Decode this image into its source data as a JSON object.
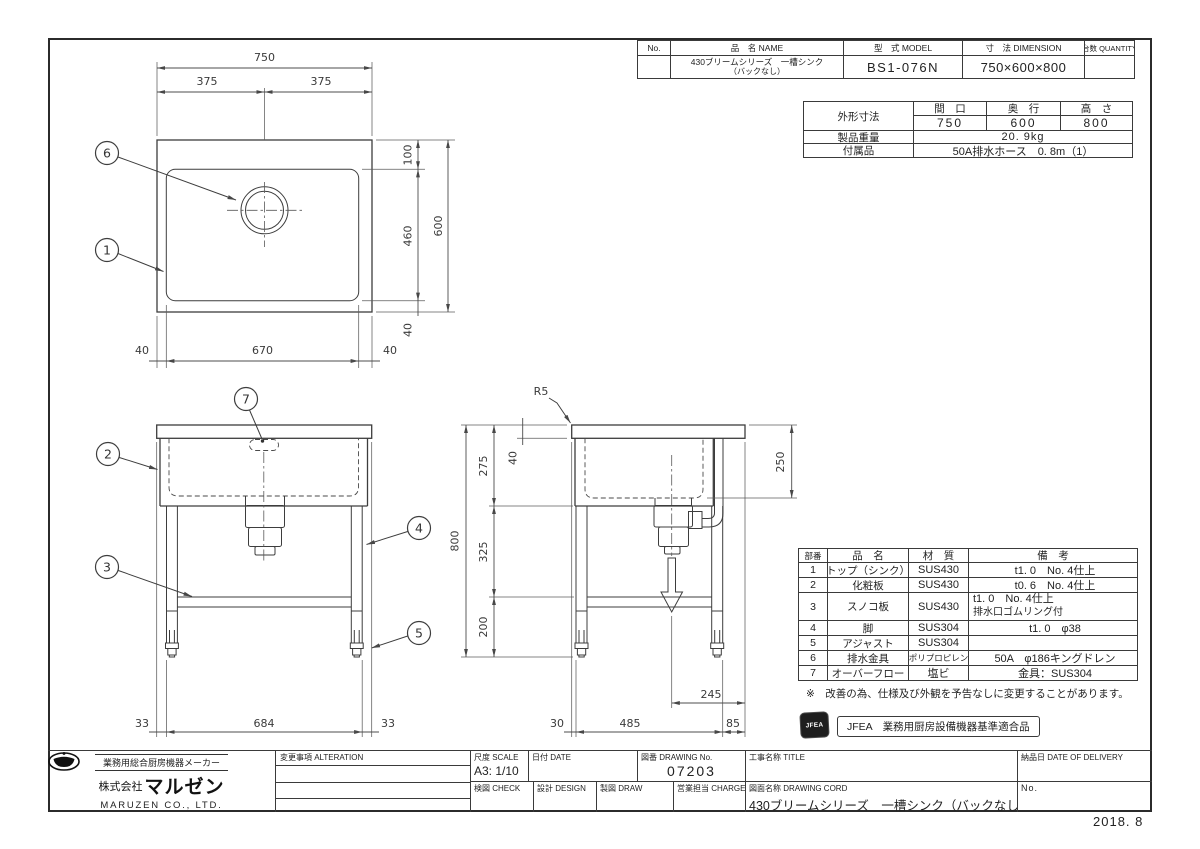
{
  "frame": {
    "year_note": "2018. 8"
  },
  "product_table": {
    "col_no": "No.",
    "col_name": "品　名 NAME",
    "col_model": "型　式 MODEL",
    "col_dimension": "寸　法 DIMENSION",
    "col_quantity": "台数 QUANTITY",
    "name_line1": "430ブリームシリーズ　一槽シンク",
    "name_line2": "（バックなし）",
    "model": "BS1-076N",
    "dimension": "750×600×800"
  },
  "spec_table": {
    "outer_label": "外形寸法",
    "col_width": "間　口",
    "col_depth": "奥　行",
    "col_height": "高　さ",
    "width": "750",
    "depth": "600",
    "height": "800",
    "weight_label": "製品重量",
    "weight": "20. 9kg",
    "accessory_label": "付属品",
    "accessory": "50A排水ホース　0. 8m（1）"
  },
  "parts_table": {
    "col_no": "部番",
    "col_name": "品　名",
    "col_material": "材　質",
    "col_remarks": "備　考",
    "rows": [
      {
        "no": "1",
        "name": "トップ（シンク）",
        "material": "SUS430",
        "remark": "t1. 0　No. 4仕上",
        "remark2": ""
      },
      {
        "no": "2",
        "name": "化粧板",
        "material": "SUS430",
        "remark": "t0. 6　No. 4仕上",
        "remark2": ""
      },
      {
        "no": "3",
        "name": "スノコ板",
        "material": "SUS430",
        "remark": "t1. 0　No. 4仕上",
        "remark2": "排水口ゴムリング付"
      },
      {
        "no": "4",
        "name": "脚",
        "material": "SUS304",
        "remark": "t1. 0　φ38",
        "remark2": ""
      },
      {
        "no": "5",
        "name": "アジャスト",
        "material": "SUS304",
        "remark": "",
        "remark2": ""
      },
      {
        "no": "6",
        "name": "排水金具",
        "material": "ポリプロピレン",
        "remark": "50A　φ186キングドレン",
        "remark2": ""
      },
      {
        "no": "7",
        "name": "オーバーフロー",
        "material": "塩ビ",
        "remark": "金具：SUS304",
        "remark2": ""
      }
    ]
  },
  "notes": {
    "disclaimer": "※　改善の為、仕様及び外観を予告なしに変更することがあります。"
  },
  "jfea": {
    "stamp": "JFEA",
    "label": "JFEA　業務用厨房設備機器基準適合品"
  },
  "title_block": {
    "maker_tagline": "業務用総合厨房機器メーカー",
    "company_prefix": "株式会社",
    "company_name": "マルゼン",
    "company_en": "MARUZEN CO., LTD.",
    "alteration_label": "変更事項 ALTERATION",
    "scale_label": "尺度 SCALE",
    "scale_value": "A3: 1/10",
    "date_label": "日付 DATE",
    "drawing_no_label": "図番 DRAWING No.",
    "drawing_no": "07203",
    "title_label": "工事名称 TITLE",
    "check_label": "検図 CHECK",
    "design_label": "設計 DESIGN",
    "draw_label": "製図 DRAW",
    "charge_label": "営業担当 CHARGE",
    "drawing_name_label": "図面名称 DRAWING CORD",
    "drawing_name": "430ブリームシリーズ　一槽シンク（バックなし）",
    "delivery_label": "納品日 DATE OF DELIVERY",
    "no_label": "No."
  },
  "views": {
    "plan": {
      "callout_6": "6",
      "callout_1": "1",
      "dims": {
        "total_width": "750",
        "half_left": "375",
        "half_right": "375",
        "back_inset": "100",
        "bowl_depth": "460",
        "total_depth": "600",
        "front_inset": "40",
        "left_inset": "40",
        "bowl_width": "670",
        "right_inset": "40"
      }
    },
    "front": {
      "callout_7": "7",
      "callout_2": "2",
      "callout_3": "3",
      "callout_4": "4",
      "callout_5": "5",
      "dims": {
        "left": "33",
        "span": "684",
        "right": "33"
      }
    },
    "side": {
      "radius": "R5",
      "dims": {
        "total_height": "800",
        "top": "275",
        "slab": "40",
        "mid": "325",
        "leg": "200",
        "overflow": "250",
        "b_left": "30",
        "b_span": "485",
        "b_right": "85",
        "drain_offset": "245"
      }
    }
  }
}
